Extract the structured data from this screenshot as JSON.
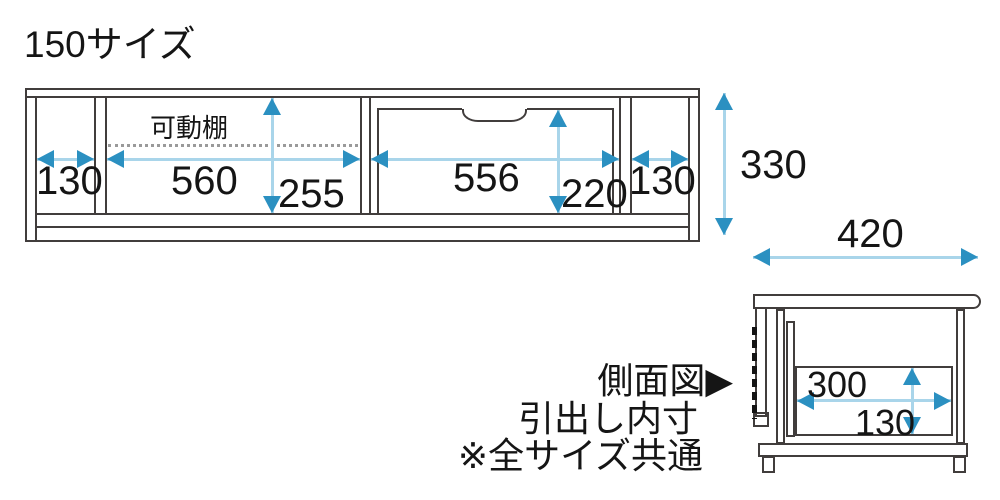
{
  "title": "150サイズ",
  "front_view": {
    "shelf_label": "可動棚",
    "dim_left_width": "130",
    "dim_shelf_width": "560",
    "dim_shelf_height": "255",
    "dim_drawer_width": "556",
    "dim_drawer_height": "220",
    "dim_right_width": "130",
    "dim_total_height": "330"
  },
  "side_view": {
    "dim_depth": "420",
    "dim_drawer_depth": "300",
    "dim_drawer_inner_height": "130"
  },
  "notes": {
    "line1": "側面図▶",
    "line2": "引出し内寸",
    "line3": "※全サイズ共通"
  },
  "colors": {
    "structure": "#413d3c",
    "arrow_head": "#2b90c1",
    "arrow_line": "#a9d5ea",
    "shelf_dotted": "#9a9a9a",
    "text": "#151515"
  }
}
